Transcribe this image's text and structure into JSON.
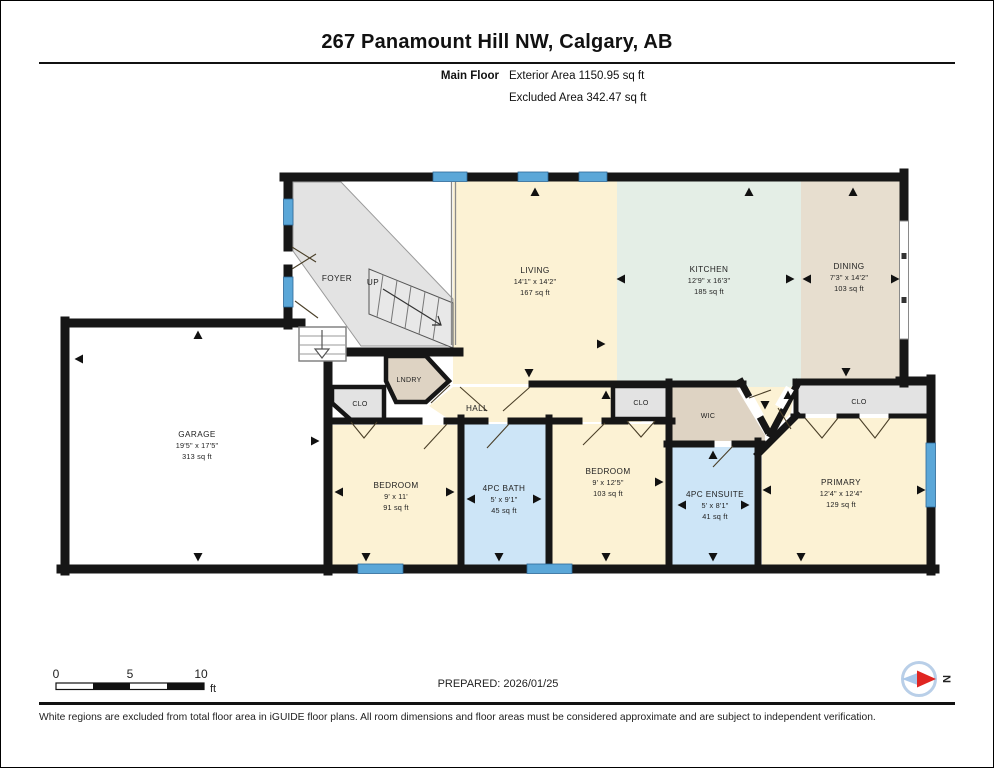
{
  "header": {
    "title": "267 Panamount Hill NW, Calgary, AB",
    "floor_label": "Main Floor",
    "exterior_area": "Exterior Area 1150.95 sq ft",
    "excluded_area": "Excluded Area 342.47 sq ft"
  },
  "rooms": {
    "foyer": {
      "name": "FOYER"
    },
    "stairs_up": {
      "name": "UP"
    },
    "living": {
      "name": "LIVING",
      "dims": "14'1\" x 14'2\"",
      "area": "167 sq ft"
    },
    "kitchen": {
      "name": "KITCHEN",
      "dims": "12'9\" x 16'3\"",
      "area": "185 sq ft"
    },
    "dining": {
      "name": "DINING",
      "dims": "7'3\" x 14'2\"",
      "area": "103 sq ft"
    },
    "garage": {
      "name": "GARAGE",
      "dims": "19'5\" x 17'5\"",
      "area": "313 sq ft"
    },
    "clo1": {
      "name": "CLO"
    },
    "lndry": {
      "name": "LNDRY"
    },
    "hall": {
      "name": "HALL"
    },
    "bedroom1": {
      "name": "BEDROOM",
      "dims": "9' x 11'",
      "area": "91 sq ft"
    },
    "bath": {
      "name": "4PC BATH",
      "dims": "5' x 9'1\"",
      "area": "45 sq ft"
    },
    "bedroom2": {
      "name": "BEDROOM",
      "dims": "9' x 12'5\"",
      "area": "103 sq ft"
    },
    "clo2": {
      "name": "CLO"
    },
    "wic": {
      "name": "WIC"
    },
    "ensuite": {
      "name": "4PC ENSUITE",
      "dims": "5' x 8'1\"",
      "area": "41 sq ft"
    },
    "clo3": {
      "name": "CLO"
    },
    "primary": {
      "name": "PRIMARY",
      "dims": "12'4\" x 12'4\"",
      "area": "129 sq ft"
    }
  },
  "scale_bar": {
    "tick0": "0",
    "tick5": "5",
    "tick10": "10",
    "unit": "ft"
  },
  "compass": {
    "label": "N"
  },
  "footer": {
    "prepared": "PREPARED: 2026/01/25",
    "disclaimer": "White regions are excluded from total floor area in iGUIDE floor plans. All room dimensions and floor areas must be considered approximate and are subject to independent verification."
  },
  "colors": {
    "wall": "#161616",
    "window_blue": "#5ba7d8",
    "room_cream": "#fcf2d4",
    "room_mint": "#e4eee6",
    "room_tan": "#e7decf",
    "room_tan_dark": "#ded3c3",
    "room_gray": "#e3e3e3",
    "room_bath_blue": "#cde5f7",
    "compass_red": "#e02521",
    "compass_blue": "#a9c7e9"
  }
}
